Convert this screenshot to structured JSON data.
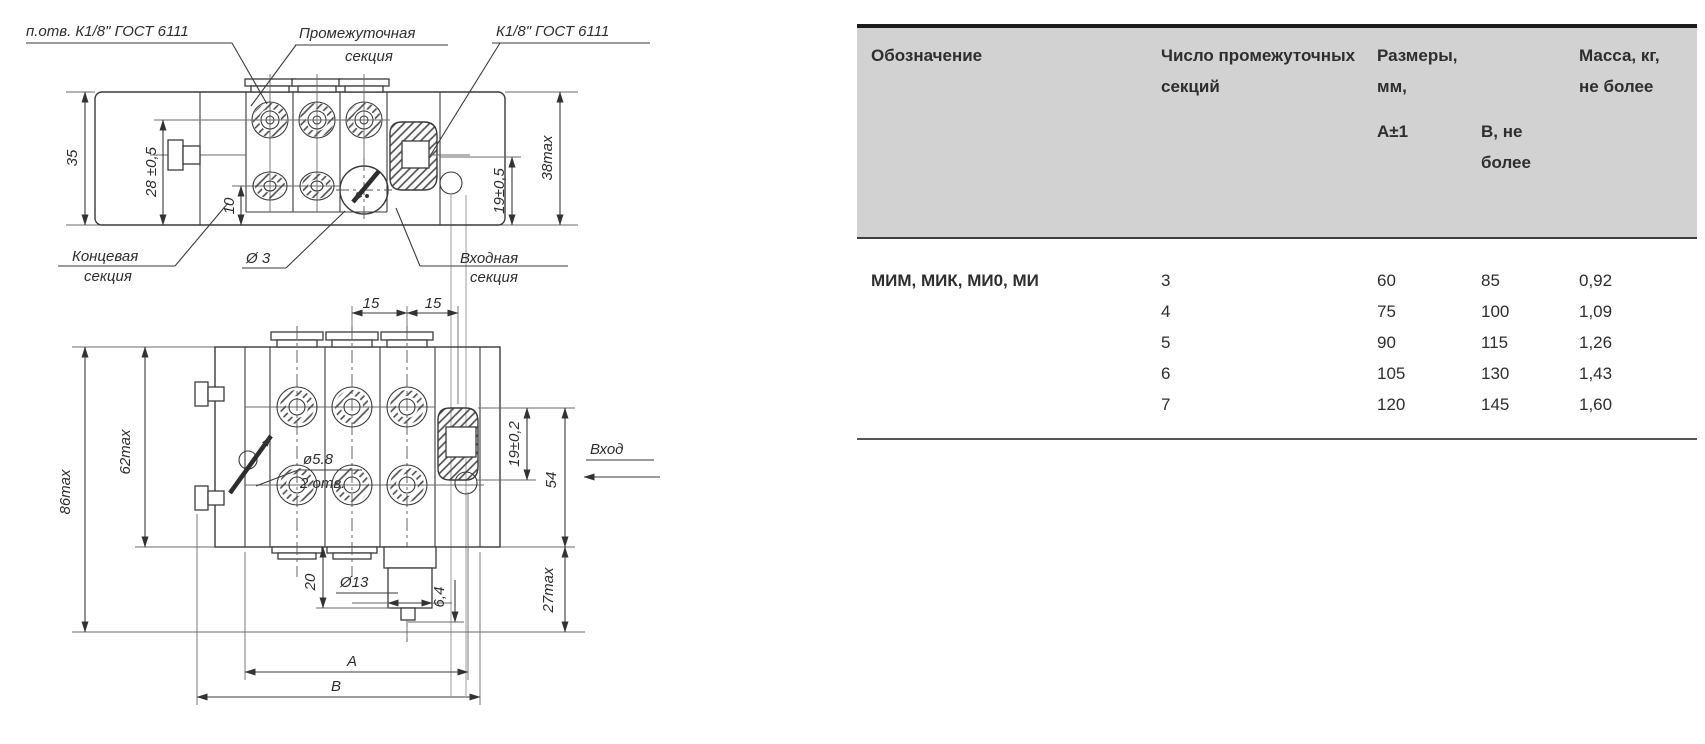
{
  "top_view": {
    "callout_hole": "п.отв. К1/8\" ГОСТ 6111",
    "callout_intermediate_1": "Промежуточная",
    "callout_intermediate_2": "секция",
    "callout_thread": "К1/8\" ГОСТ 6111",
    "callout_end_1": "Концевая",
    "callout_end_2": "секция",
    "callout_dia3": "Ø 3",
    "callout_inlet_1": "Входная",
    "callout_inlet_2": "секция",
    "dim_35": "35",
    "dim_28": "28 ±0,5",
    "dim_10": "10",
    "dim_19": "19±0,5",
    "dim_38": "38max"
  },
  "front_view": {
    "dim_15_left": "15",
    "dim_15_right": "15",
    "dim_86": "86max",
    "dim_62": "62max",
    "dim_hole_dia": "ø5.8",
    "dim_hole_qty": "2 отв.",
    "dim_19": "19±0,2",
    "dim_54": "54",
    "dim_20": "20",
    "dim_13": "Ø13",
    "dim_6_4": "6,4",
    "dim_27": "27max",
    "dim_A": "A",
    "dim_B": "B",
    "label_inlet": "Вход"
  },
  "table": {
    "col_designation": "Обозначение",
    "col_sections": "Число промежуточных секций",
    "col_dimensions": "Размеры, мм,",
    "col_dim_a": "А±1",
    "col_dim_b": "В, не более",
    "col_mass": "Масса, кг, не более",
    "designation": "МИМ, МИК, МИ0, МИ",
    "rows": [
      {
        "sections": "3",
        "a": "60",
        "b": "85",
        "mass": "0,92"
      },
      {
        "sections": "4",
        "a": "75",
        "b": "100",
        "mass": "1,09"
      },
      {
        "sections": "5",
        "a": "90",
        "b": "115",
        "mass": "1,26"
      },
      {
        "sections": "6",
        "a": "105",
        "b": "130",
        "mass": "1,43"
      },
      {
        "sections": "7",
        "a": "120",
        "b": "145",
        "mass": "1,60"
      }
    ]
  }
}
